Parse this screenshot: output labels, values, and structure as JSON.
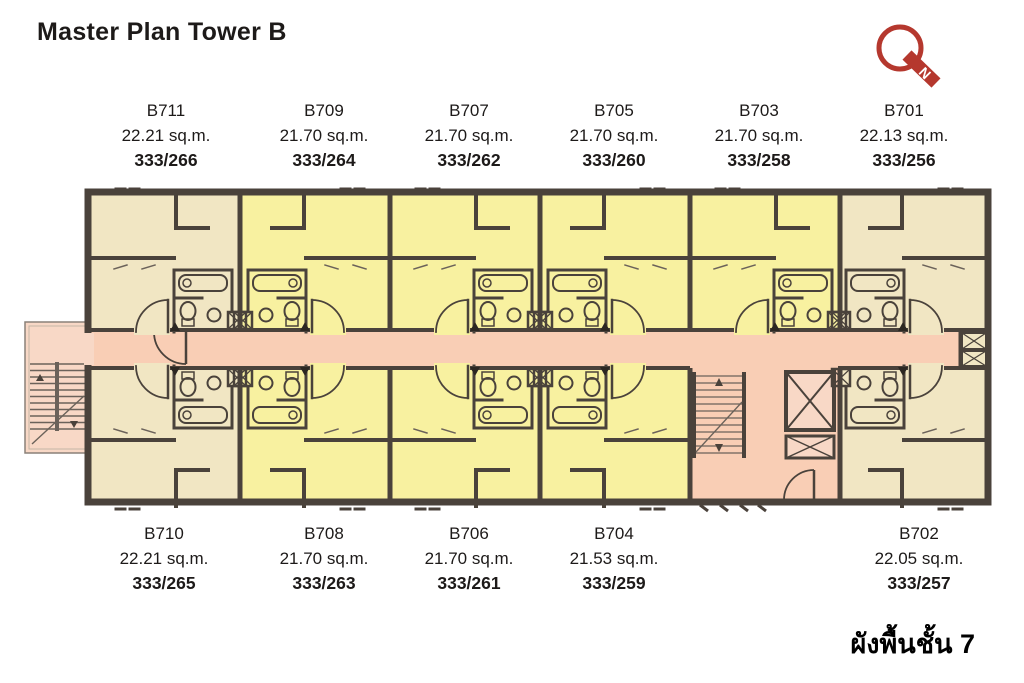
{
  "page": {
    "title": "Master Plan Tower B",
    "floor_caption": "ผังพื้นชั้น 7"
  },
  "logo": {
    "description": "red Q monogram with diagonal tail",
    "tail_letter": "N",
    "color": "#b5382e"
  },
  "colors": {
    "text": "#1d1a19",
    "wall": "#4a423b",
    "unit_yellow": "#f8f1a0",
    "unit_tan": "#f1e6c3",
    "corridor": "#f9ceb5",
    "stair": "#f8d8c6",
    "logo_red": "#b5382e"
  },
  "units": {
    "top": [
      {
        "number": "B711",
        "area": "22.21 sq.m.",
        "code": "333/266"
      },
      {
        "number": "B709",
        "area": "21.70 sq.m.",
        "code": "333/264"
      },
      {
        "number": "B707",
        "area": "21.70 sq.m.",
        "code": "333/262"
      },
      {
        "number": "B705",
        "area": "21.70 sq.m.",
        "code": "333/260"
      },
      {
        "number": "B703",
        "area": "21.70 sq.m.",
        "code": "333/258"
      },
      {
        "number": "B701",
        "area": "22.13 sq.m.",
        "code": "333/256"
      }
    ],
    "bottom": [
      {
        "number": "B710",
        "area": "22.21 sq.m.",
        "code": "333/265"
      },
      {
        "number": "B708",
        "area": "21.70 sq.m.",
        "code": "333/263"
      },
      {
        "number": "B706",
        "area": "21.70 sq.m.",
        "code": "333/261"
      },
      {
        "number": "B704",
        "area": "21.53 sq.m.",
        "code": "333/259"
      },
      {
        "number": "B702",
        "area": "22.05 sq.m.",
        "code": "333/257"
      }
    ]
  }
}
